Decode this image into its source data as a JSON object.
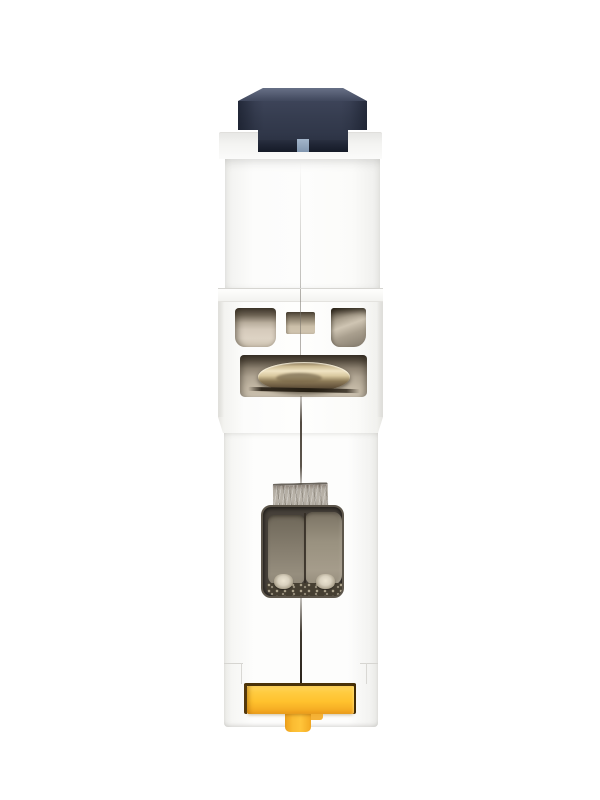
{
  "scene": {
    "type": "product-photo",
    "subject": "single-pole DIN-rail miniature circuit breaker viewed end-on",
    "background": "#ffffff"
  },
  "colors": {
    "toggle_top": "#4d5569",
    "toggle_main": "#363d50",
    "toggle_dark": "#262c3c",
    "indicator_blue": "#8196af",
    "indicator_blue_light": "#a3b5ca",
    "body": "#fcfcfb",
    "body_shade": "#e9e9e6",
    "body_edge": "#dcdbd7",
    "opening_deep": "#3e362b",
    "opening_sand": "#d5cabb",
    "opening_olive": "#8d8475",
    "ring_highlight": "#f0e4c4",
    "ring_gold": "#cdbb93",
    "ring_bronze": "#8d7b58",
    "ring_dark": "#3f3425",
    "wire": "#322a1f",
    "plate": "#b2aca2",
    "plate_dark": "#6a655d",
    "recess": "#47413a",
    "pad_left": "#847c6d",
    "pad_right": "#99917f",
    "pad_divider": "#332c23",
    "floor": "#463f32",
    "foot": "#d9d1bf",
    "clip_yellow": "#ffc22e",
    "clip_yellow_light": "#ffd65f",
    "clip_orange": "#ee9e1c",
    "clip_outline": "#53380c",
    "seam": "#4a4238"
  }
}
